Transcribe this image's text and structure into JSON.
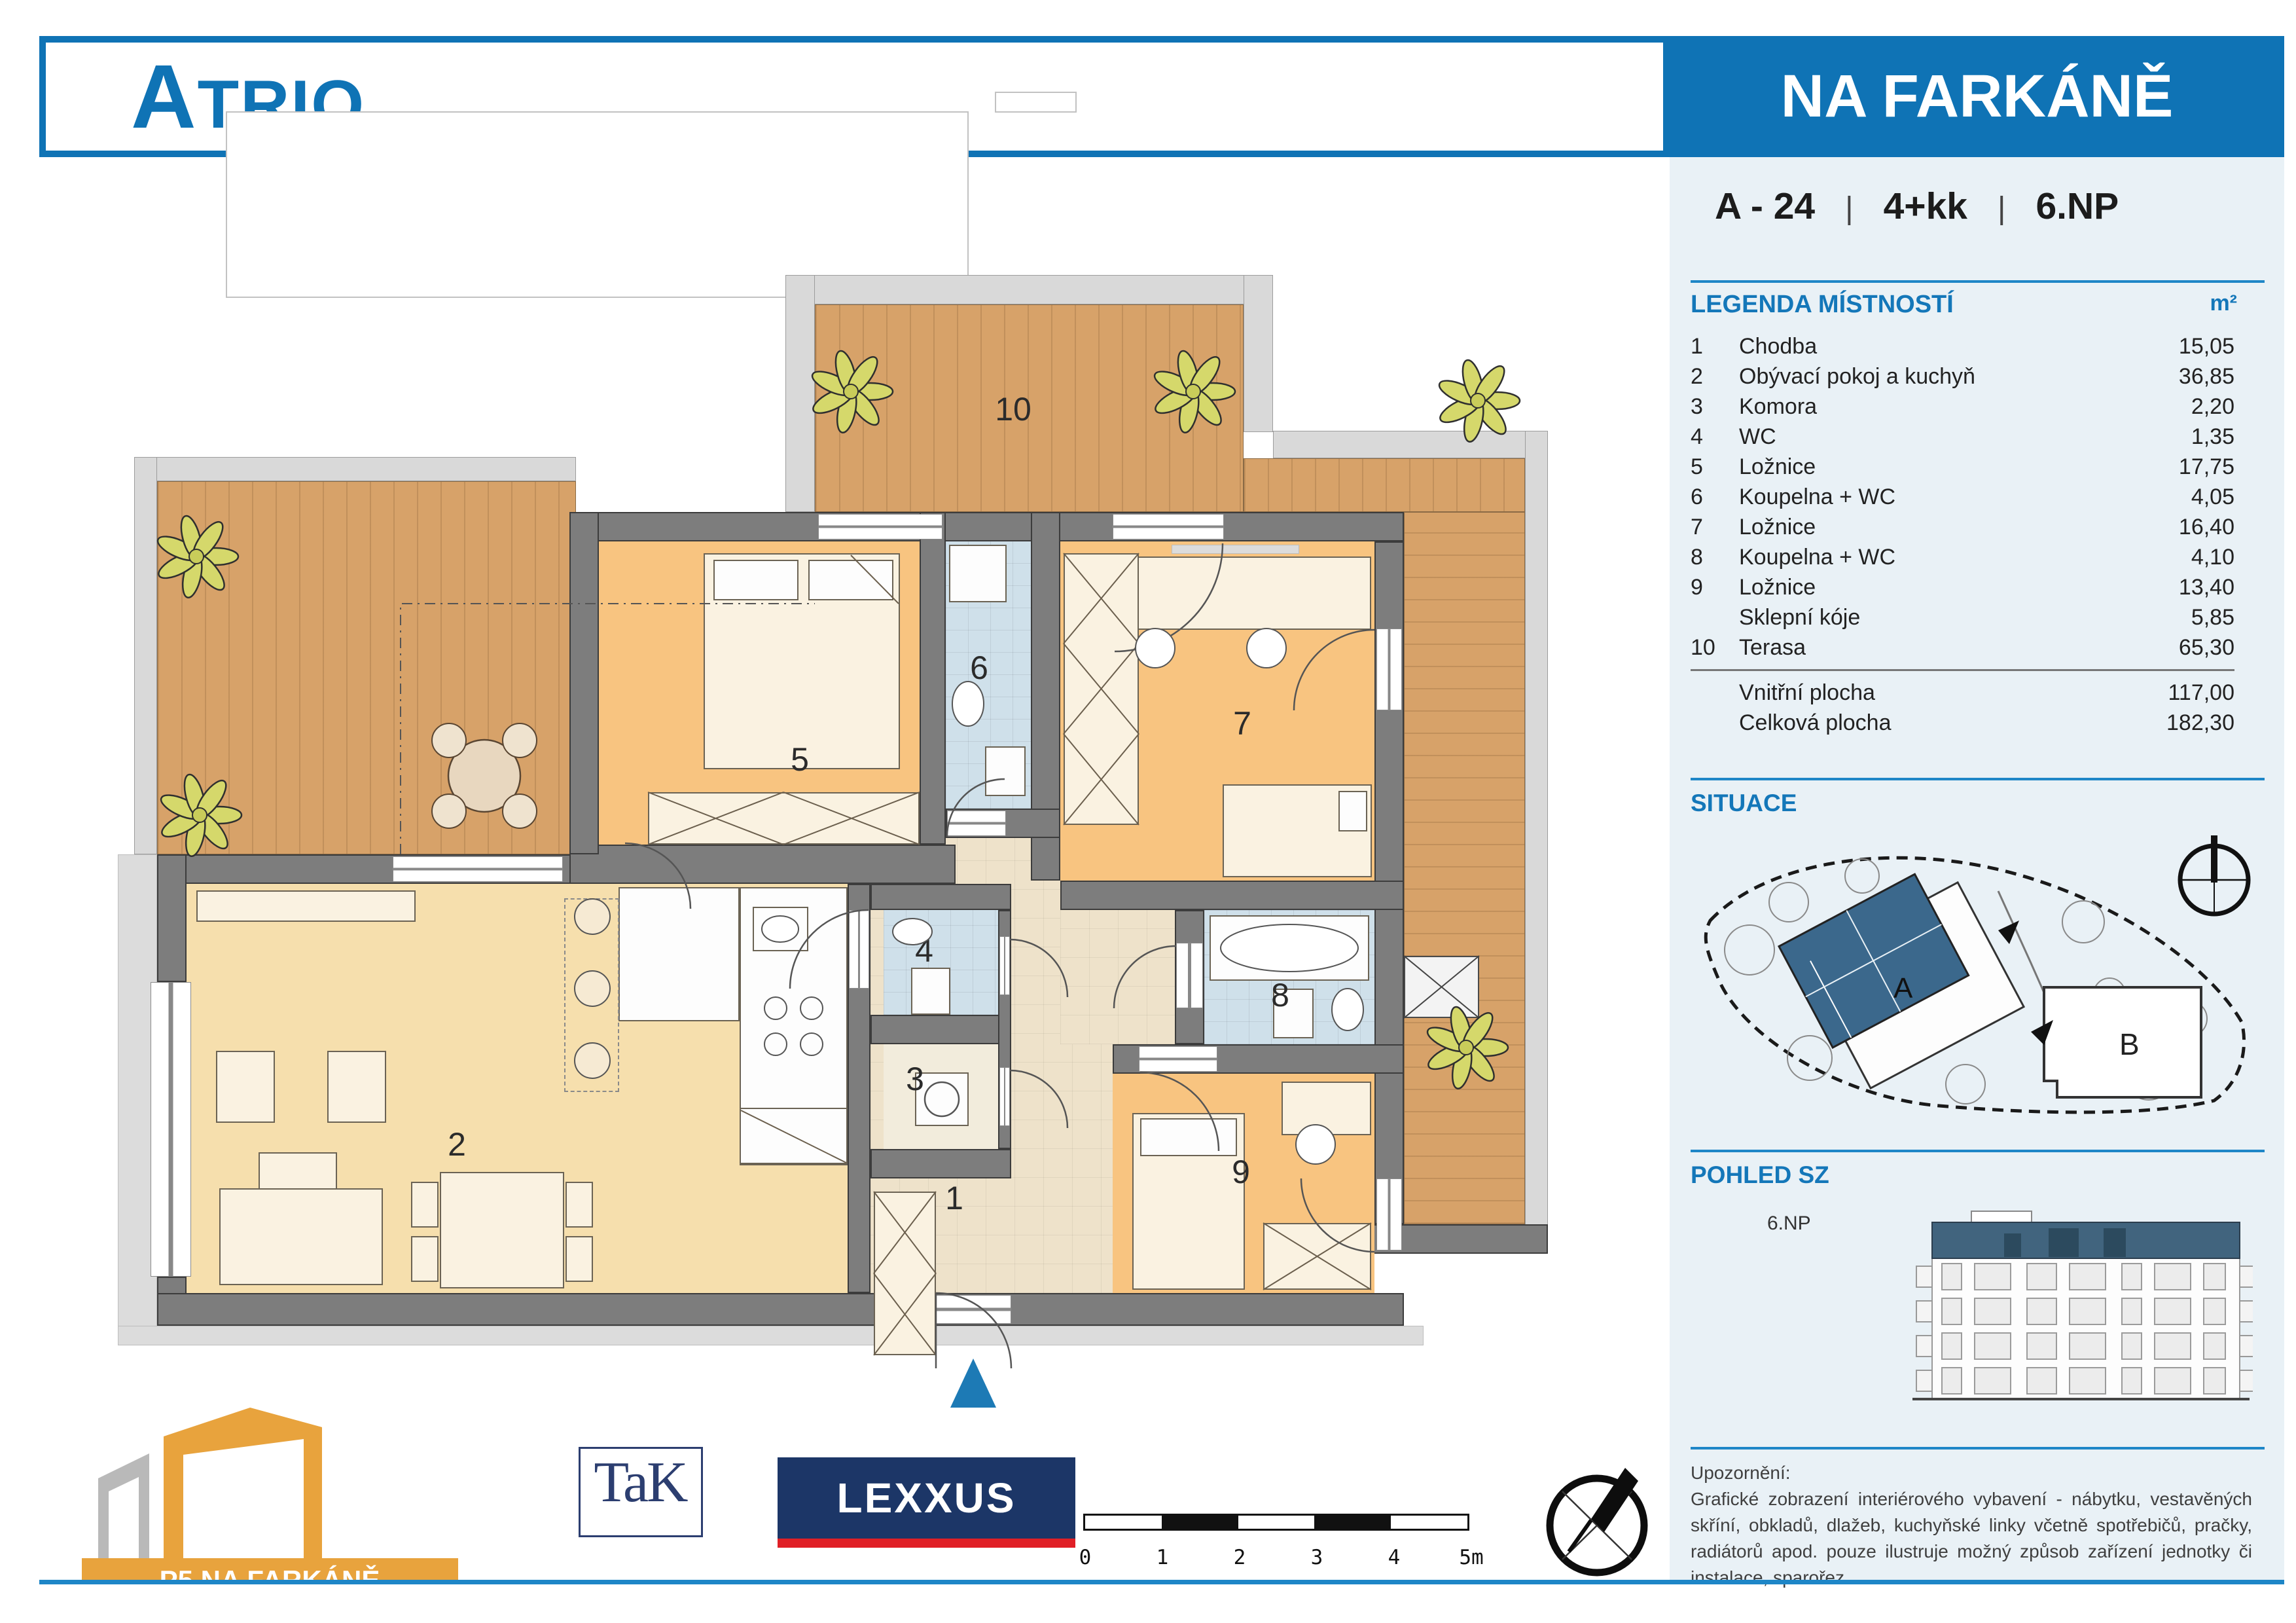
{
  "header": {
    "brand": "ATRIO",
    "project": "NA FARKÁNĚ"
  },
  "unit": {
    "code": "A - 24",
    "layout": "4+kk",
    "floor": "6.NP",
    "separator": "|"
  },
  "legend": {
    "title": "LEGENDA MÍSTNOSTÍ",
    "unit_label": "m²",
    "rows": [
      {
        "num": "1",
        "name": "Chodba",
        "area": "15,05"
      },
      {
        "num": "2",
        "name": "Obývací pokoj a kuchyň",
        "area": "36,85"
      },
      {
        "num": "3",
        "name": "Komora",
        "area": "2,20"
      },
      {
        "num": "4",
        "name": "WC",
        "area": "1,35"
      },
      {
        "num": "5",
        "name": "Ložnice",
        "area": "17,75"
      },
      {
        "num": "6",
        "name": "Koupelna + WC",
        "area": "4,05"
      },
      {
        "num": "7",
        "name": "Ložnice",
        "area": "16,40"
      },
      {
        "num": "8",
        "name": "Koupelna + WC",
        "area": "4,10"
      },
      {
        "num": "9",
        "name": "Ložnice",
        "area": "13,40"
      },
      {
        "num": "",
        "name": "Sklepní kóje",
        "area": "5,85"
      },
      {
        "num": "10",
        "name": "Terasa",
        "area": "65,30"
      }
    ],
    "totals": [
      {
        "name": "Vnitřní plocha",
        "area": "117,00"
      },
      {
        "name": "Celková plocha",
        "area": "182,30"
      }
    ]
  },
  "situace": {
    "title": "SITUACE",
    "label_a": "A",
    "label_b": "B"
  },
  "pohled": {
    "title": "POHLED SZ",
    "floor_label": "6.NP"
  },
  "notice": {
    "title": "Upozornění:",
    "body": "Grafické zobrazení interiérového vybavení - nábytku, vestavěných skříní, obkladů, dlažeb, kuchyňské linky včetně spotřebičů, pračky, radiátorů apod. pouze ilustruje možný způsob zařízení jednotky či instalace, sparořez."
  },
  "logos": {
    "p5": "P5 NA FARKÁNĚ",
    "tak": "TaK",
    "lexxus": "LEXXUS"
  },
  "scalebar": {
    "labels": [
      "0",
      "1",
      "2",
      "3",
      "4",
      "5m"
    ]
  },
  "plan": {
    "room_numbers": [
      "1",
      "2",
      "3",
      "4",
      "5",
      "6",
      "7",
      "8",
      "9",
      "10"
    ]
  },
  "colors": {
    "accent_blue": "#0f73b5",
    "line_blue": "#1e86c7",
    "sidebar_bg": "#e9f1f6",
    "wall_gray": "#7d7d7d",
    "terrace_wood": "#d7a269",
    "bedroom_orange": "#f8c480",
    "living_beige": "#f6dfad",
    "bath_blue": "#cfe0ea",
    "entry_arrow": "#1d7ab5",
    "p5_orange": "#e8a33d",
    "lexxus_navy": "#1c3667",
    "lexxus_red": "#e01f26"
  }
}
